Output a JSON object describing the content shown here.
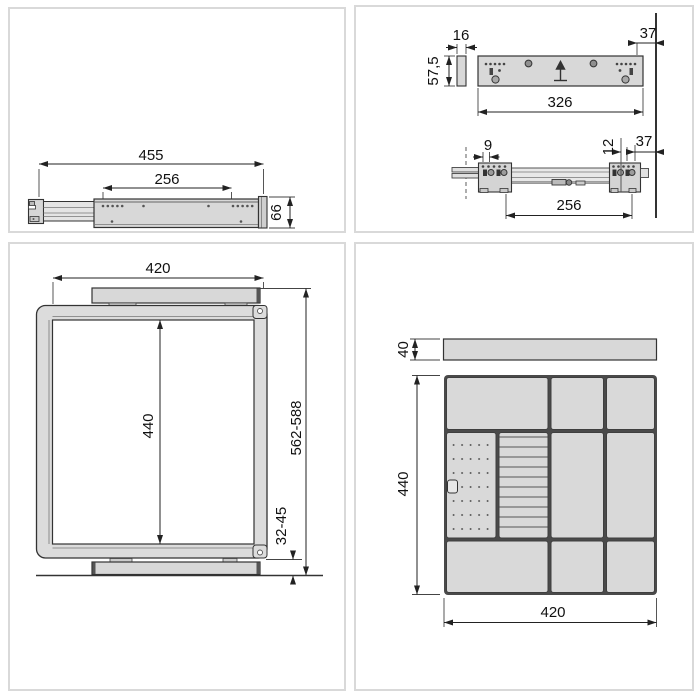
{
  "colors": {
    "panel_border": "#d9d9d9",
    "outline": "#333333",
    "dimension_line": "#222222",
    "metal_fill": "#d8d8d8",
    "metal_fill_light": "#e4e4e4",
    "divider_dark": "#4a4a4a",
    "hole": "#555555",
    "text": "#111111"
  },
  "panels": {
    "top_left": {
      "view": "drawer-slide-side-view",
      "labels": {
        "total_length": "455",
        "hole_spacing": "256",
        "height": "66"
      }
    },
    "top_right": {
      "view": "mounting-plate-and-rail-views",
      "labels": {
        "spacer_thickness": "16",
        "spacer_height": "57,5",
        "plate_length": "326",
        "top_wall_offset": "37",
        "front_offset": "9",
        "rear_offset": "12",
        "side_wall_offset": "37",
        "hole_spacing": "256"
      }
    },
    "bottom_left": {
      "view": "frame-front-view",
      "labels": {
        "width": "420",
        "inner_height": "440",
        "mounting_height": "562-588",
        "bottom_clearance": "32-45"
      }
    },
    "bottom_right": {
      "view": "tray-top-view",
      "labels": {
        "bar_depth": "40",
        "tray_depth": "440",
        "tray_width": "420"
      }
    }
  }
}
